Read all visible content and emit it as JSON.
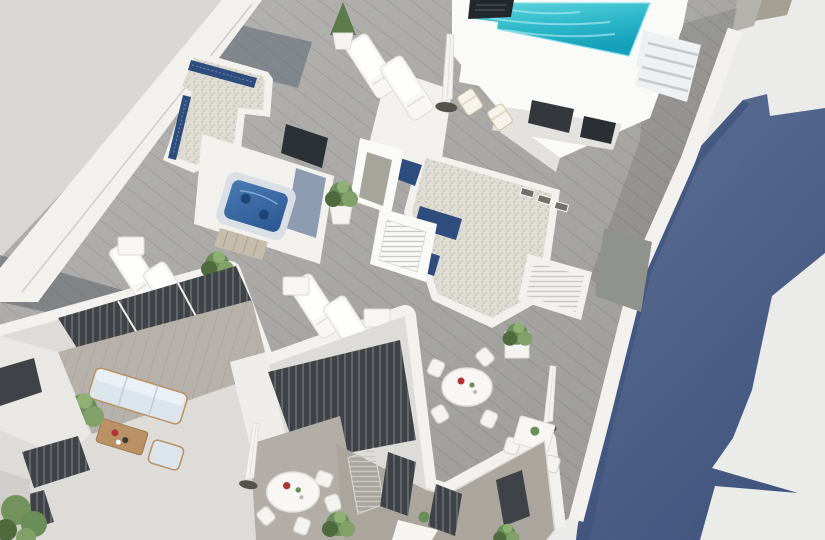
{
  "scene": {
    "type": "3d-architectural-render",
    "view": "aerial isometric bird's-eye view",
    "subject": "Daylight 3D render of a modern white apartment building rooftop: turquoise swimming pool with stairs, jacuzzi, gravel roofs with blue skylight strips, wooden deck terraces with sun loungers, closed parasols, potted plants, round dining tables, and lower balconies with an outdoor sofa; the building casts a large slate-blue shadow on the ground to the right.",
    "time_of_day": "day"
  },
  "palette": {
    "ground_white": "#ebebe9",
    "backdrop": "#d8d7d5",
    "white_bright": "#fafaf8",
    "white_wall": "#f2f1ee",
    "white_shade": "#e2e1de",
    "deck_wood": "#a8a7a5",
    "deck_shadow": "#5d6674",
    "walkway": "#919194",
    "gravel": "#dedbd3",
    "gravel_dot": "#b5b1a7",
    "skylight_blue": "#2e4d7e",
    "pool_turquoise": "#3fc6d3",
    "pool_deep": "#149fba",
    "jacuzzi_blue": "#3a6ba6",
    "shadow_blue": "#586b90",
    "shadow_blue_dark": "#42557e",
    "plant_green": "#6b8d57",
    "plant_dark": "#4f6a3c",
    "sofa_blue": "#dce4ec",
    "wood_tan": "#b99165",
    "accent_red": "#b03530",
    "glass_dark": "#3f4347",
    "concrete": "#aaa69e"
  },
  "objects": [
    "swimming-pool",
    "pool-stairs",
    "chimney",
    "stair-bulkhead",
    "skylight-gravel-roof",
    "jacuzzi",
    "sun-loungers",
    "deck-chairs",
    "closed-parasols",
    "potted-plants",
    "round-dining-tables",
    "square-table",
    "outdoor-sofa",
    "coffee-table",
    "armchair",
    "balcony-windows",
    "louvered-doors",
    "wood-deck",
    "walkway",
    "cast-shadow",
    "tree"
  ]
}
